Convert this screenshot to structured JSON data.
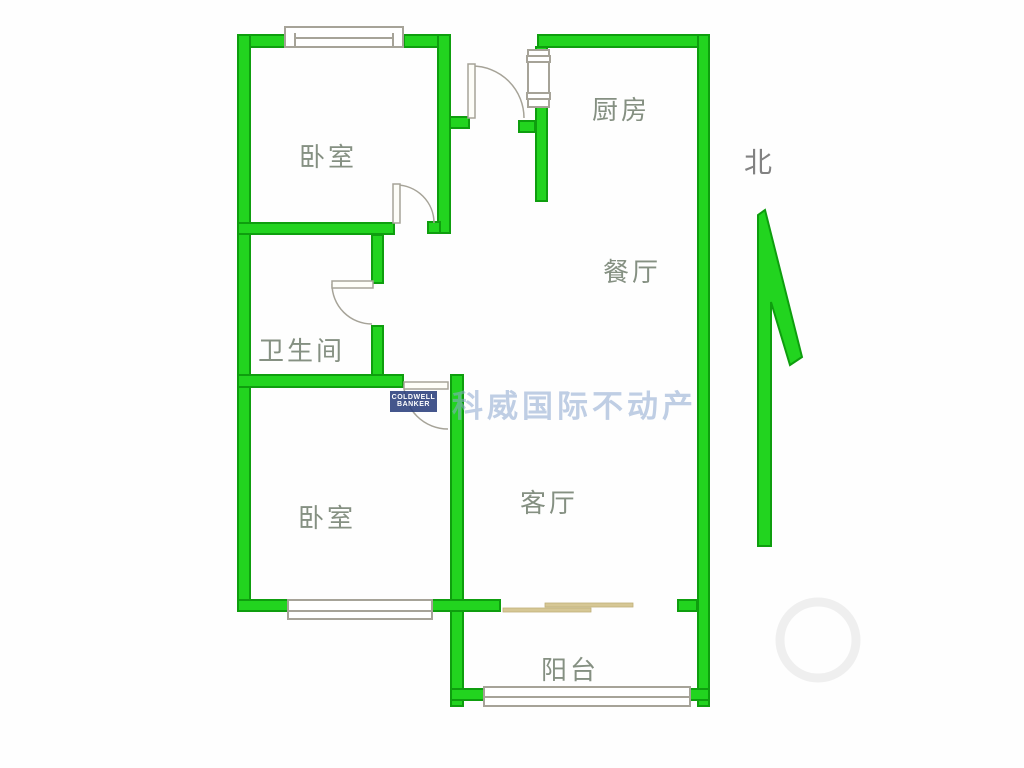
{
  "colors": {
    "wall_fill": "#22d41f",
    "wall_edge": "#0e9e0e",
    "line_gray": "#a6a398",
    "door_beige": "#d6c795",
    "label_color": "#859082",
    "north_color": "#828282",
    "watermark_blue": "#8da7d0",
    "logo_navy": "#2b3f7d",
    "bg": "#fefefe"
  },
  "rooms": [
    {
      "id": "bedroom-top",
      "label": "卧室"
    },
    {
      "id": "kitchen",
      "label": "厨房"
    },
    {
      "id": "dining",
      "label": "餐厅"
    },
    {
      "id": "bathroom",
      "label": "卫生间"
    },
    {
      "id": "bedroom-bottom",
      "label": "卧室"
    },
    {
      "id": "living",
      "label": "客厅"
    },
    {
      "id": "balcony",
      "label": "阳台"
    }
  ],
  "compass": {
    "label": "北"
  },
  "watermark": {
    "brand_cn": "科威国际不动产",
    "logo_line1": "COLDWELL",
    "logo_line2": "BANKER"
  }
}
